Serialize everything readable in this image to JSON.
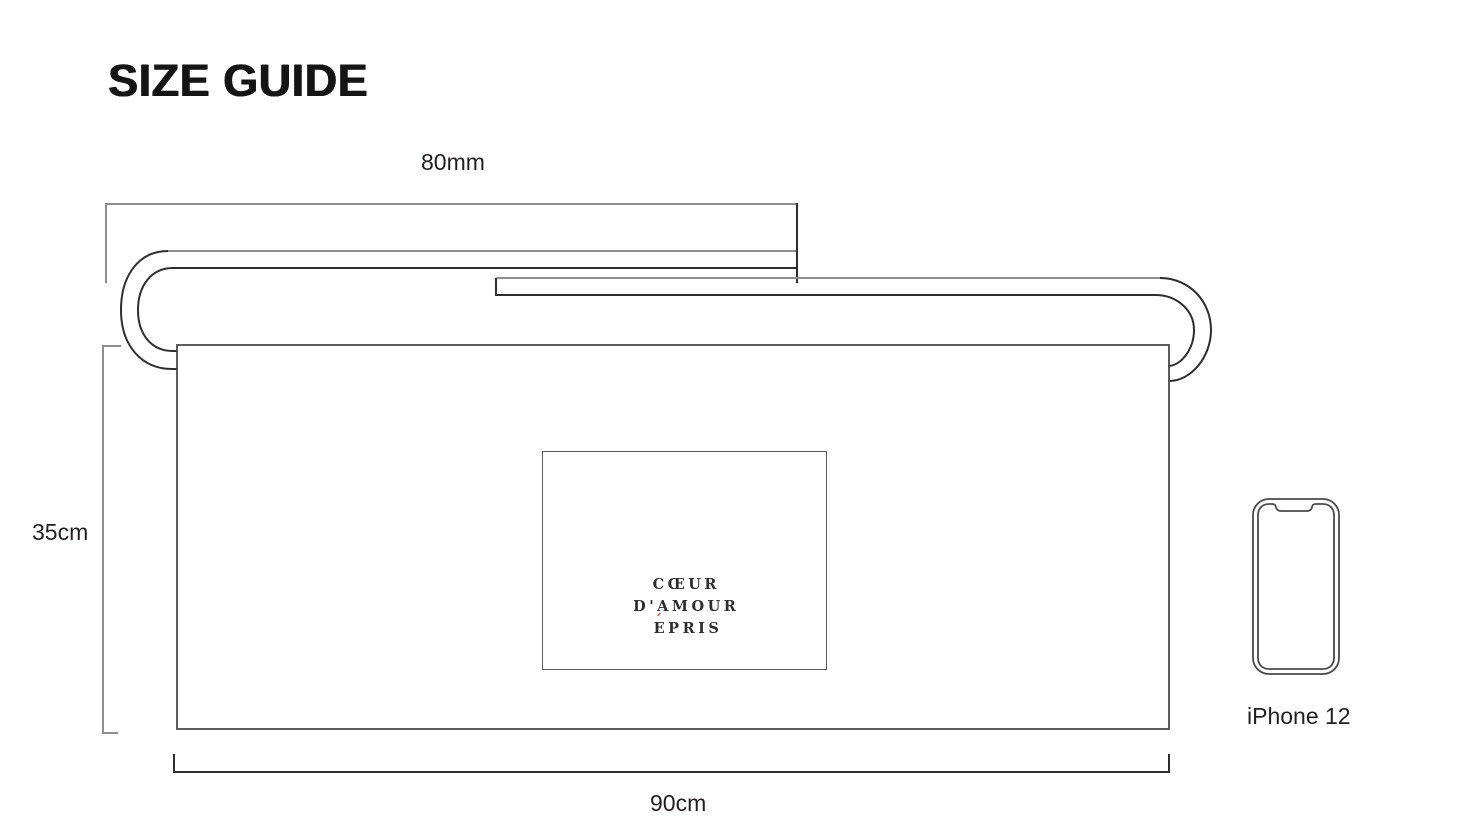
{
  "title": "SIZE GUIDE",
  "measurements": {
    "strap": "80mm",
    "height": "35cm",
    "width": "90cm"
  },
  "reference_object": {
    "label": "iPhone 12"
  },
  "brand_label": {
    "lines": [
      "CŒUR",
      "D'AMOUR",
      "ÉPRIS"
    ],
    "line3_accent": "´",
    "line3_base": "E",
    "line3_rest": "PRIS"
  },
  "icons": {
    "phone": "iphone-outline-icon"
  },
  "colors": {
    "background": "#ffffff",
    "bracket_gray": "#8e8e8e",
    "line_dark": "#2e2e2e",
    "outline": "#4a4a4a",
    "text": "#231f20",
    "accent_red": "#c43b3b"
  }
}
